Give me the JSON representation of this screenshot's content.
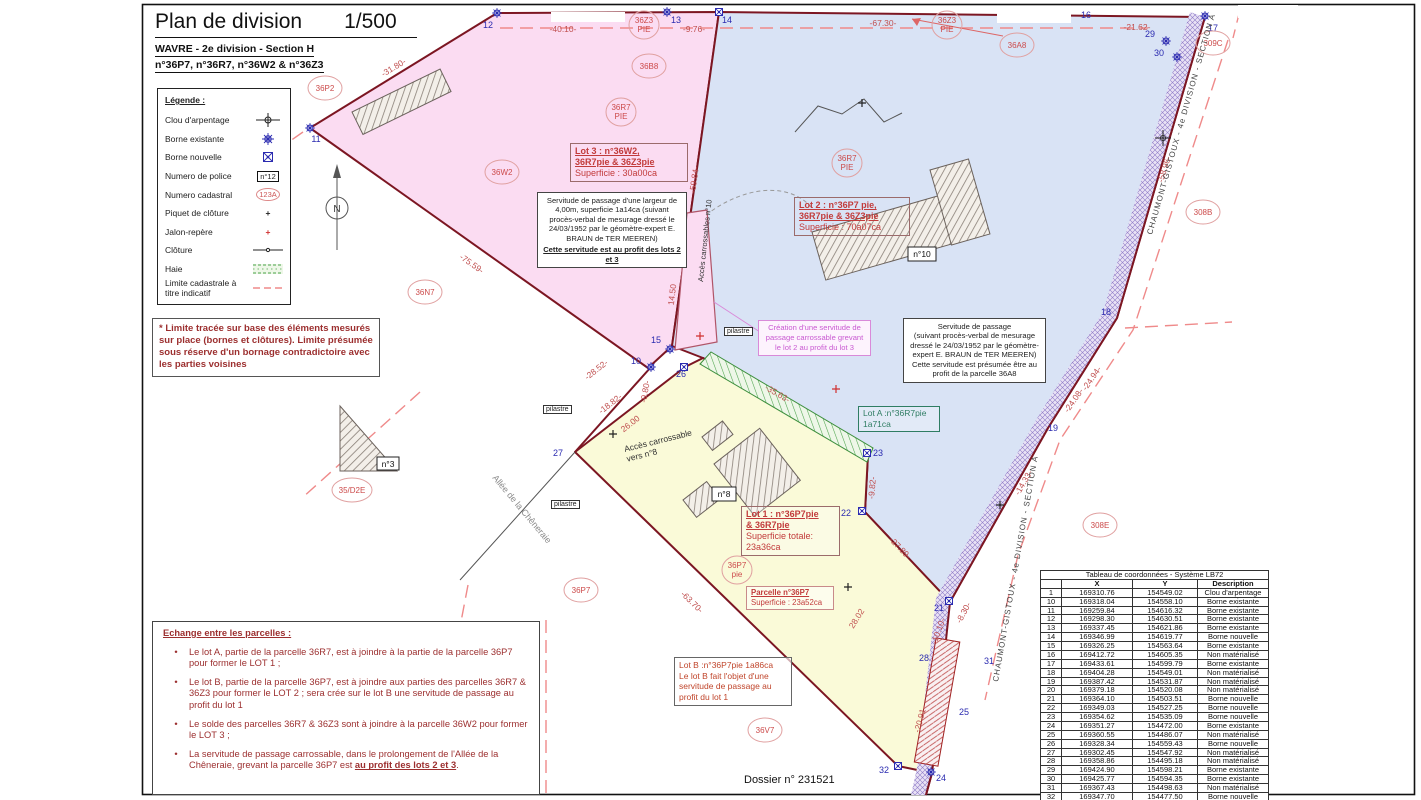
{
  "title": {
    "main": "Plan de division",
    "scale": "1/500",
    "sub1": "WAVRE - 2e division - Section H",
    "sub2": "n°36P7, n°36R7, n°36W2 & n°36Z3"
  },
  "legend": {
    "title": "Légende :",
    "items": [
      "Clou d'arpentage",
      "Borne existante",
      "Borne nouvelle",
      "Numero de police",
      "Numero cadastral",
      "Piquet de clôture",
      "Jalon-repère",
      "Clôture",
      "Haie",
      "Limite cadastrale à titre indicatif"
    ],
    "police_sample": "n°12",
    "cadastral_sample": "123A",
    "piquet_glyph": "+",
    "jalon_glyph": "+"
  },
  "notes": {
    "boundary_note": "* Limite tracée sur base des éléments mesurés sur place (bornes et clôtures). Limite présumée sous réserve d'un bornage contradictoire avec les parties voisines",
    "exchange_title": "Echange entre les parcelles :",
    "bullets": [
      "Le lot A, partie de la parcelle 36R7, est à joindre à la partie de la parcelle 36P7 pour former le LOT 1 ;",
      "Le lot B, partie de la parcelle 36P7, est à joindre aux parties des parcelles 36R7 & 36Z3 pour former le LOT 2 ; sera crée sur le lot B une servitude de passage au profit du lot 1",
      "Le solde des parcelles 36R7 & 36Z3 sont à joindre à la parcelle 36W2 pour former le LOT 3 ;"
    ],
    "bullet4_main": "La servitude de passage carrossable, dans le prolongement de l'Allée de la Chêneraie, grevant la parcelle 36P7 est ",
    "bullet4_emph": "au profit des lots 2 et 3",
    "bullet4_tail": "."
  },
  "servitudes": {
    "left_body": "Servitude de passage d'une largeur de 4,00m, superficie 1a14ca (suivant procès-verbal de mesurage dressé le 24/03/1952 par le géomètre-expert E. BRAUN de TER MEEREN)",
    "left_emph": "Cette servitude est au profit des lots 2 et 3",
    "right_line1": "Servitude de passage",
    "right_body": "(suivant procès-verbal de mesurage dressé le 24/03/1952 par le géomètre-expert E. BRAUN de TER MEEREN)",
    "right_line3": "Cette servitude est présumée être au profit de la parcelle 36A8",
    "creation": "Création d'une servitude de passage carrossable grevant le lot 2 au profit du lot 3"
  },
  "lots": {
    "lot3_l1": "Lot 3 : n°36W2,",
    "lot3_l2": "36R7pie & 36Z3pie",
    "lot3_l3": "Superficie : 30a00ca",
    "lot2_l1": "Lot 2 : n°36P7 pie,",
    "lot2_l2": "36R7pie & 36Z3pie",
    "lot2_l3": "Superficie : 70a07ca",
    "lot1_l1": "Lot 1 : n°36P7pie",
    "lot1_l2": "& 36R7pie",
    "lot1_l3": "Superficie totale:",
    "lot1_l4": "23a36ca",
    "lotA_l1": "Lot A :n°36R7pie",
    "lotA_l2": "1a71ca",
    "lotB_l1": "Lot B :n°36P7pie 1a86ca",
    "lotB_l2": "Le lot B fait l'objet d'une servitude de passage au profit du lot 1",
    "parcel_l1": "Parcelle n°36P7",
    "parcel_l2": "Superficie : 23a52ca"
  },
  "plan": {
    "north": "N",
    "road_label": "CHAUMONT-GISTOUX - 4e DIVISION - SECTION A",
    "allee": "Allée de la Chêneraie",
    "acces10": "Accès carrossables n°10",
    "acces8_line1": "Accès carrossable",
    "acces8_line2": "vers n°8",
    "pilastre": "pilastre",
    "measurements": [
      "-31.80-",
      "-40.10-",
      "-9.76-",
      "-67.30-",
      "-21.62-",
      "-59.84-",
      "-75.59-",
      "-28.52-",
      "-18.82-",
      "-9.80-",
      "26.00",
      "14.50",
      "-35.63-",
      "-9.82-",
      "-27.89-",
      "28.02",
      "-10.10-",
      "-20.91-",
      "-63.70-",
      "-58.96-",
      "-24.94-",
      "-24.08-",
      "-14.33-",
      "-8.30-"
    ],
    "points": [
      "10",
      "11",
      "12",
      "13",
      "14",
      "15",
      "16",
      "17",
      "18",
      "19",
      "21",
      "22",
      "23",
      "24",
      "25",
      "26",
      "27",
      "28",
      "29",
      "30",
      "31",
      "32"
    ],
    "circles": [
      {
        "l1": "36P2"
      },
      {
        "l1": "36B8"
      },
      {
        "l1": "36Z3",
        "l2": "PIE"
      },
      {
        "l1": "36Z3",
        "l2": "PIE"
      },
      {
        "l1": "36A8"
      },
      {
        "l1": "309C"
      },
      {
        "l1": "36R7",
        "l2": "PIE"
      },
      {
        "l1": "36W2"
      },
      {
        "l1": "36R7",
        "l2": "PIE"
      },
      {
        "l1": "36N7"
      },
      {
        "l1": "308B"
      },
      {
        "l1": "308E"
      },
      {
        "l1": "36P7"
      },
      {
        "l1": "36P7",
        "l2": "pie"
      },
      {
        "l1": "36V7"
      },
      {
        "l1": "35/D2E"
      }
    ],
    "police": [
      "n°10",
      "n°8",
      "n°3"
    ]
  },
  "footer": {
    "dossier": "Dossier n° 231521"
  },
  "coords_table": {
    "title": "Tableau de coordonnées - Système LB72",
    "headers": [
      "X",
      "Y",
      "Description"
    ],
    "rows": [
      [
        "1",
        "169310.76",
        "154549.02",
        "Clou d'arpentage"
      ],
      [
        "10",
        "169318.04",
        "154558.10",
        "Borne existante"
      ],
      [
        "11",
        "169259.84",
        "154616.32",
        "Borne existante"
      ],
      [
        "12",
        "169298.30",
        "154630.51",
        "Borne existante"
      ],
      [
        "13",
        "169337.45",
        "154621.86",
        "Borne existante"
      ],
      [
        "14",
        "169346.99",
        "154619.77",
        "Borne nouvelle"
      ],
      [
        "15",
        "169326.25",
        "154563.64",
        "Borne existante"
      ],
      [
        "16",
        "169412.72",
        "154605.35",
        "Non matérialisé"
      ],
      [
        "17",
        "169433.61",
        "154599.79",
        "Borne existante"
      ],
      [
        "18",
        "169404.28",
        "154549.01",
        "Non matérialisé"
      ],
      [
        "19",
        "169387.42",
        "154531.87",
        "Non matérialisé"
      ],
      [
        "20",
        "169379.18",
        "154520.08",
        "Non matérialisé"
      ],
      [
        "21",
        "169364.10",
        "154503.51",
        "Borne nouvelle"
      ],
      [
        "22",
        "169349.03",
        "154527.25",
        "Borne nouvelle"
      ],
      [
        "23",
        "169354.62",
        "154535.09",
        "Borne nouvelle"
      ],
      [
        "24",
        "169351.27",
        "154472.00",
        "Borne existante"
      ],
      [
        "25",
        "169360.55",
        "154486.07",
        "Non matérialisé"
      ],
      [
        "26",
        "169328.34",
        "154559.43",
        "Borne nouvelle"
      ],
      [
        "27",
        "169302.45",
        "154547.92",
        "Non matérialisé"
      ],
      [
        "28",
        "169358.86",
        "154495.18",
        "Non matérialisé"
      ],
      [
        "29",
        "169424.90",
        "154598.21",
        "Borne existante"
      ],
      [
        "30",
        "169425.77",
        "154594.35",
        "Borne existante"
      ],
      [
        "31",
        "169367.43",
        "154498.63",
        "Non matérialisé"
      ],
      [
        "32",
        "169347.70",
        "154477.50",
        "Borne nouvelle"
      ]
    ]
  },
  "colors": {
    "lot1_fill": "#fafad8",
    "lot2_fill": "#d9e3f5",
    "lot3_fill": "#fbdcf2",
    "boundary": "#7c1622",
    "dashed_limit": "#ef8a8a",
    "measure_red": "#c05050",
    "marker_blue": "#2b2bb0",
    "note_red": "#9c2f2f",
    "servitude_band": "#e9e2f5",
    "haie_green": "#4aa34a",
    "cadastral_red": "#cc4a4a"
  }
}
